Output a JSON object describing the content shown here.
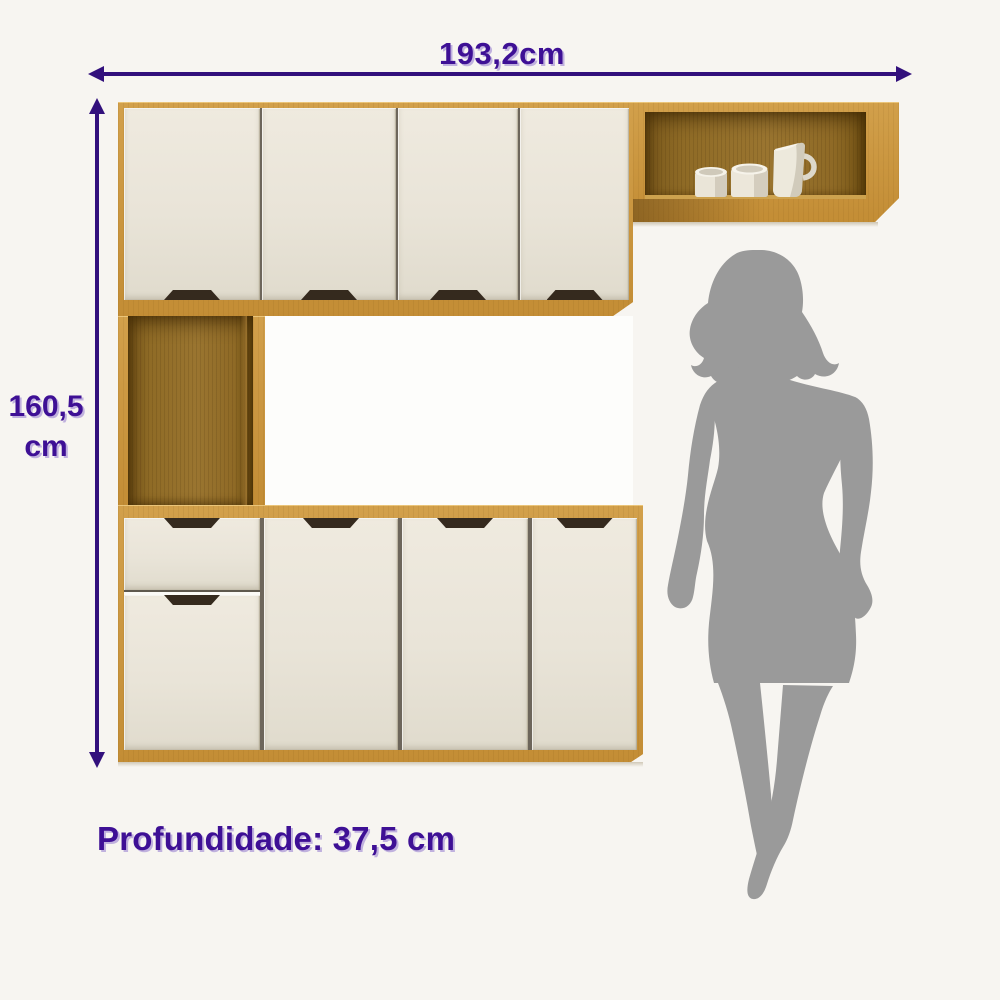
{
  "page": {
    "type": "product-dimension-diagram",
    "product": "kitchen cabinet unit"
  },
  "dimensions": {
    "width": "193,2cm",
    "height_value": "160,5",
    "height_unit": "cm",
    "depth": "Profundidade: 37,5 cm"
  },
  "colors": {
    "annotation_purple": "#3e1095",
    "arrow_purple": "#32107c",
    "wood": "#c6923c",
    "wood_interior": "#8d6824",
    "door_cream": "#e9e4d8",
    "handle_brown": "#352a1e",
    "silhouette_gray": "#9a9a9a",
    "background": "#f7f5f1"
  },
  "cabinet": {
    "upper_doors": 4,
    "lower_doors": 4,
    "drawers": 1,
    "open_niche": true,
    "wall_shelf_items": [
      "mug",
      "mug",
      "pitcher"
    ]
  },
  "figure": {
    "description": "woman silhouette shown for scale"
  }
}
